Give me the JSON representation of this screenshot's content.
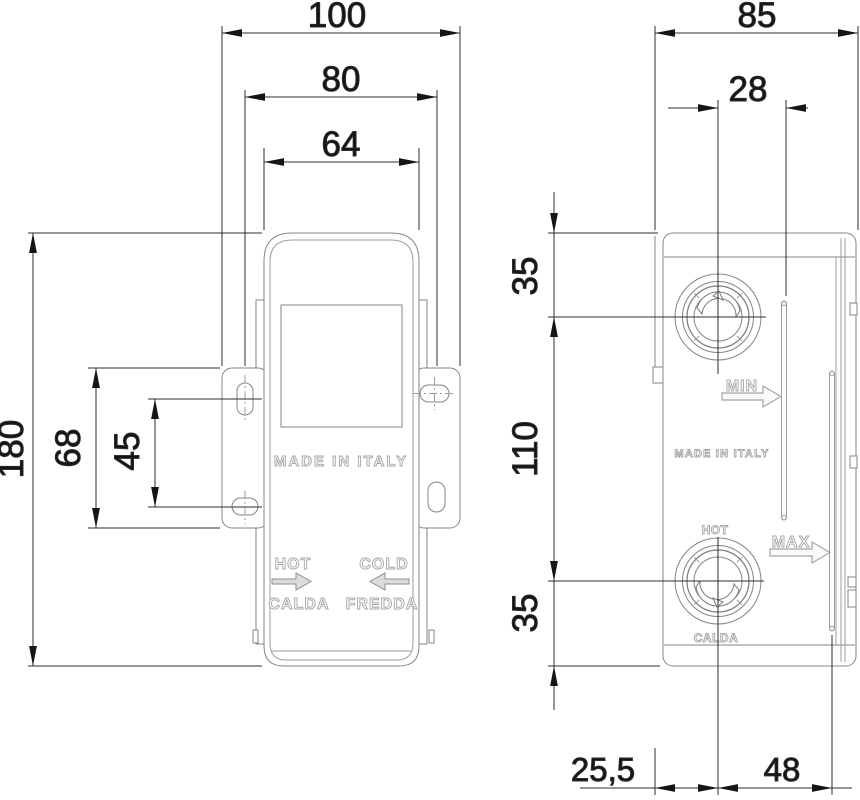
{
  "drawing": {
    "title": "thermostatic-mixing-valve-installation-drawing",
    "front": {
      "dim_overall_width": "100",
      "dim_hole_span": "80",
      "dim_body_width": "64",
      "dim_height": "180",
      "dim_bracket_height": "68",
      "dim_hole_pitch": "45",
      "label_made_in": "MADE IN ITALY",
      "label_hot": "HOT",
      "label_hot_it": "CALDA",
      "label_cold": "COLD",
      "label_cold_it": "FREDDA"
    },
    "side": {
      "dim_depth": "85",
      "dim_port_to_slot": "28",
      "dim_top_offset": "35",
      "dim_port_spacing": "110",
      "dim_bottom_offset": "35",
      "dim_front_offset": "25,5",
      "dim_back_offset": "48",
      "label_min": "MIN",
      "label_max": "MAX",
      "label_made_in": "MADE IN ITALY",
      "label_hot": "HOT",
      "label_hot_it": "CALDA"
    },
    "colors": {
      "background": "#ffffff",
      "object_line": "#858585",
      "dimension_line": "#2e2e2e",
      "dimension_text": "#141414",
      "engraving": "#a6a6a6"
    }
  }
}
